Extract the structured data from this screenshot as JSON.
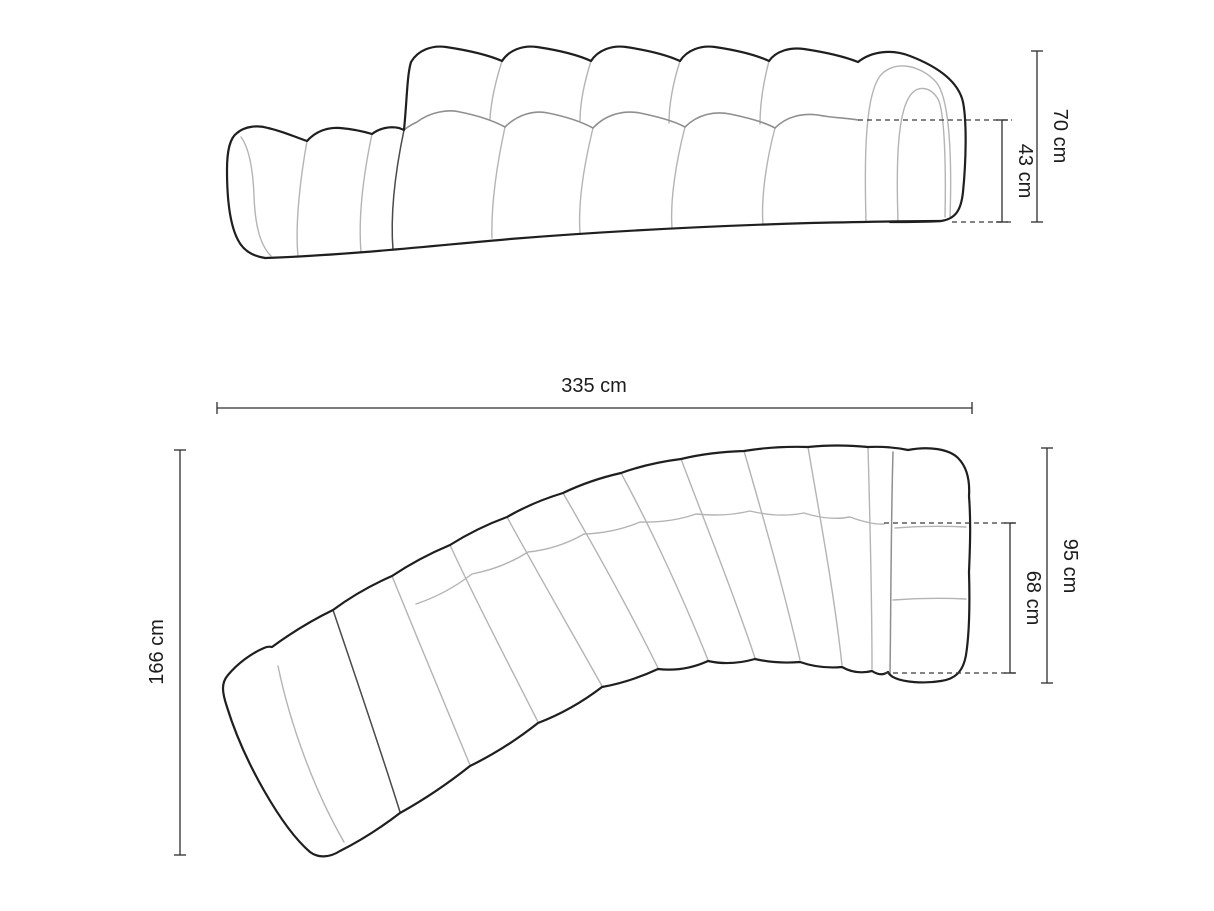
{
  "diagram": {
    "colors": {
      "outline": "#1f1f1f",
      "channel": "#b4b4b4",
      "mid": "#8f8f8f",
      "joint": "#4a4a4a",
      "dimension": "#2e2e2e",
      "dashed": "#3a3a3a",
      "background": "#ffffff"
    },
    "side_view": {
      "dimensions": {
        "total_height": {
          "label": "70 cm"
        },
        "seat_height": {
          "label": "43 cm"
        }
      }
    },
    "top_view": {
      "dimensions": {
        "total_width": {
          "label": "335 cm"
        },
        "side_depth": {
          "label": "166 cm"
        },
        "end_depth": {
          "label": "95 cm"
        },
        "seat_depth": {
          "label": "68 cm"
        }
      }
    }
  }
}
